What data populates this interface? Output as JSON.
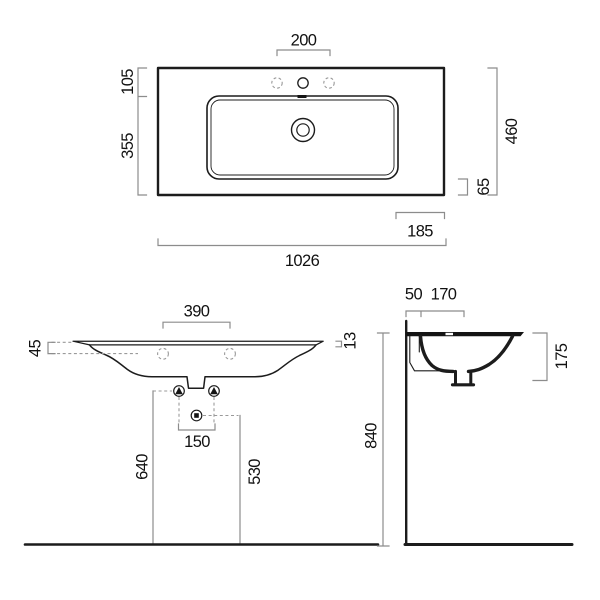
{
  "drawing_title": "Washbasin dimensional drawing",
  "colors": {
    "background": "#ffffff",
    "object_line": "#1c1c1c",
    "section_fill": "#141414",
    "dimension_line": "#8c8c8c",
    "dashed_line": "#9a9a9a",
    "label_text": "#111111"
  },
  "views": {
    "top": {
      "label": "top-view",
      "dims": {
        "faucet_hole_spacing": "200",
        "front_depth": "105",
        "bowl_depth": "355",
        "total_depth": "460",
        "rear_gap": "65",
        "side_offset": "185",
        "total_width": "1026"
      }
    },
    "front": {
      "label": "front-view",
      "dims": {
        "hole_spacing": "390",
        "edge_height": "45",
        "rim_thickness": "13",
        "anchor_spacing": "150",
        "fixing_height": "640",
        "drain_height": "530"
      }
    },
    "side": {
      "label": "side-section-view",
      "dims": {
        "wall_offset": "50",
        "drain_offset": "170",
        "basin_height": "175",
        "rim_height": "840"
      }
    }
  }
}
